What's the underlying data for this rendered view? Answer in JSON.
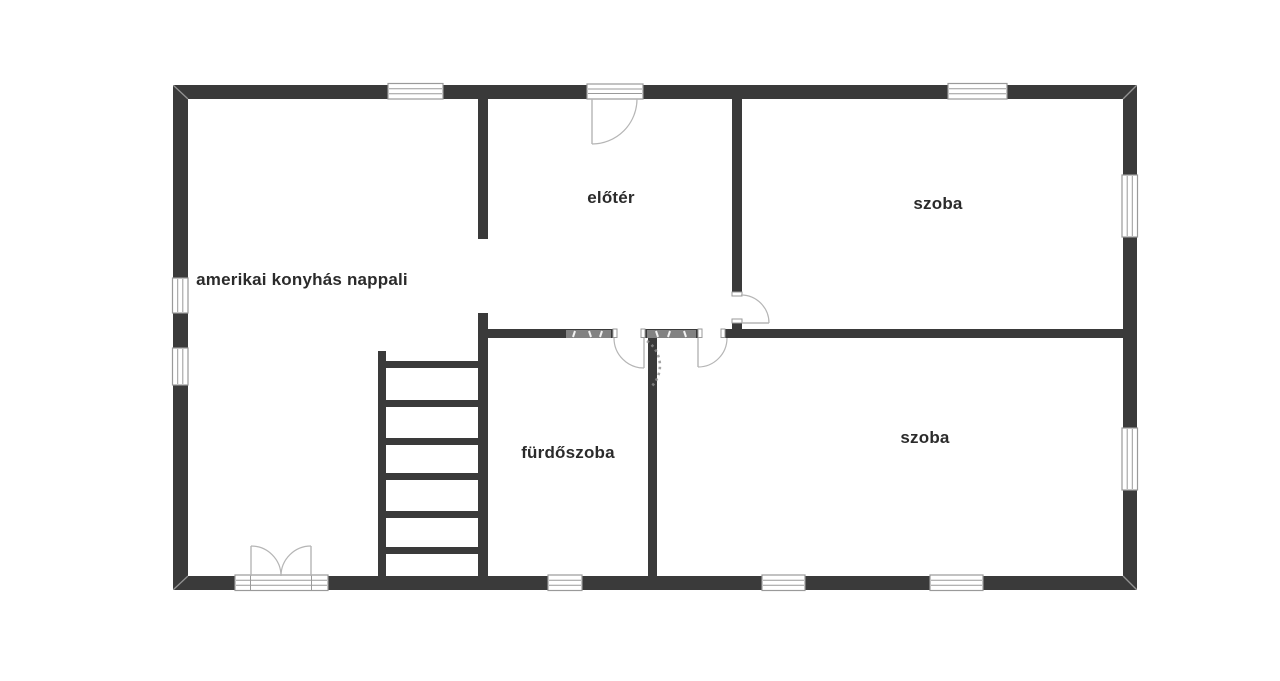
{
  "colors": {
    "background": "#ffffff",
    "wall": "#3a3a3a",
    "label": "#2b2b2b",
    "fixture": "#9a9a9a",
    "door_arc": "#b5b5b5",
    "watermark": "#8f8f8f"
  },
  "rooms": [
    {
      "id": "living-kitchen",
      "label": "amerikai konyhás nappali"
    },
    {
      "id": "hallway",
      "label": "előtér"
    },
    {
      "id": "room-top",
      "label": "szoba"
    },
    {
      "id": "bathroom",
      "label": "fürdőszoba"
    },
    {
      "id": "room-bottom",
      "label": "szoba"
    }
  ]
}
